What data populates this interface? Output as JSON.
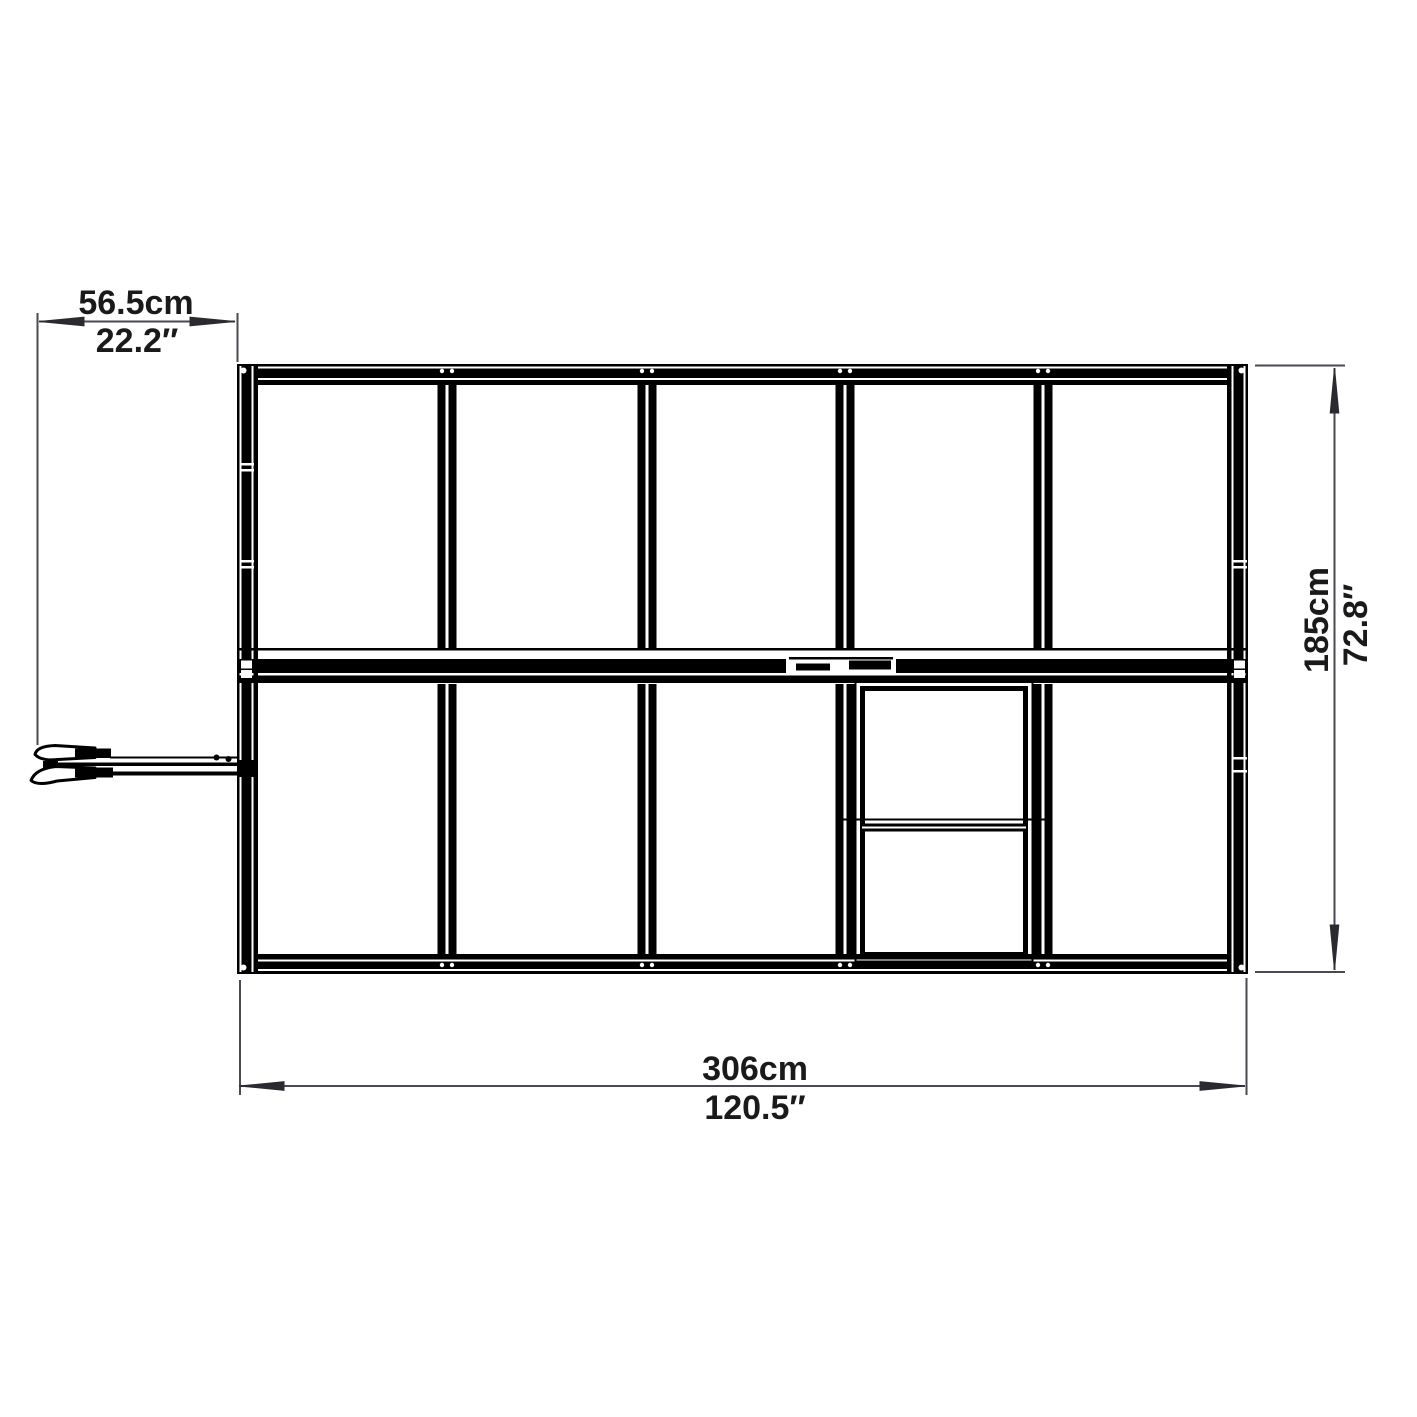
{
  "labels": {
    "door": {
      "metric": "56.5cm",
      "imperial": "22.2″"
    },
    "depth": {
      "metric": "185cm",
      "imperial": "72.8″"
    },
    "width": {
      "metric": "306cm",
      "imperial": "120.5″"
    }
  },
  "colors": {
    "background": "#ffffff",
    "frame": "#000000",
    "dimension_line": "#4a4a52",
    "arrow": "#2a2a30",
    "text": "#1a1a1a"
  }
}
